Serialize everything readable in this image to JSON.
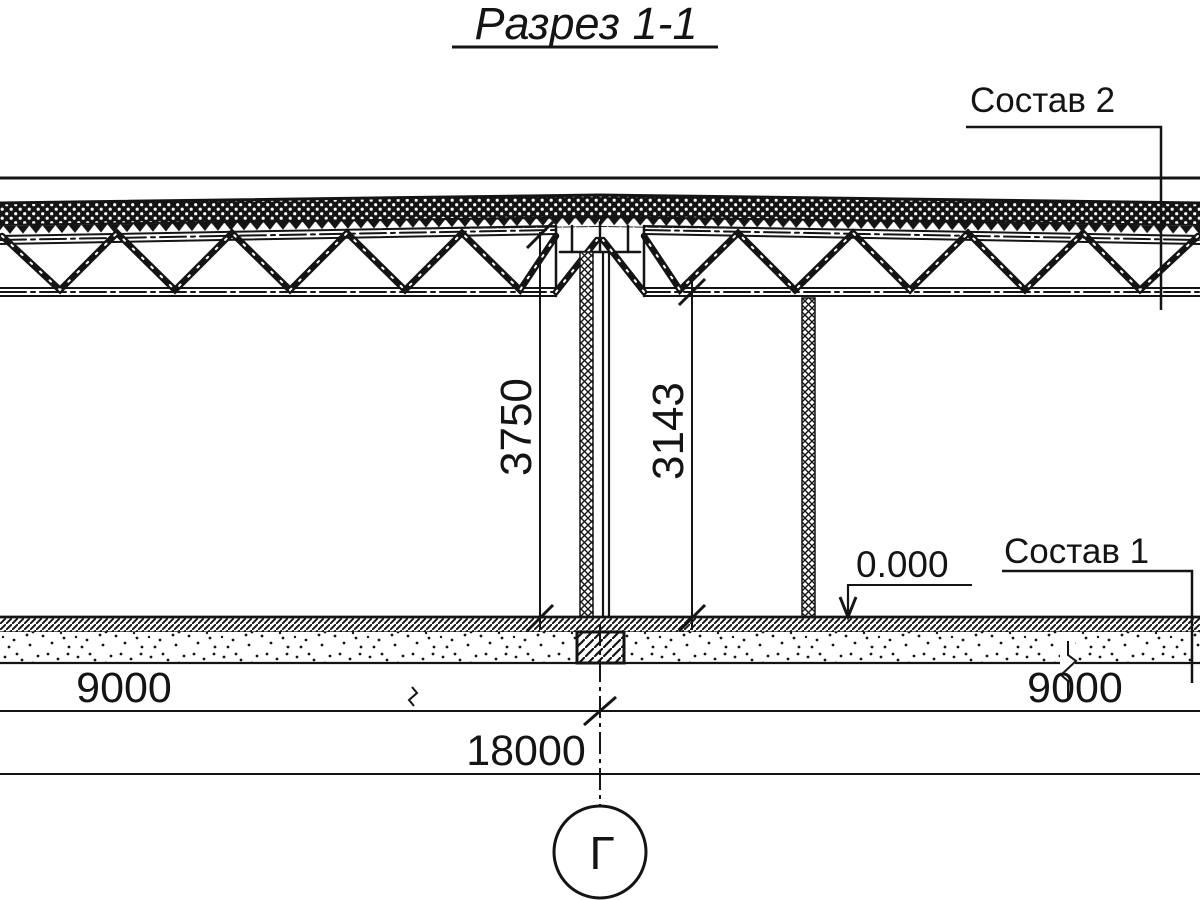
{
  "drawing": {
    "title": "Разрез 1-1",
    "callouts": {
      "roof": "Состав 2",
      "floor": "Состав 1"
    },
    "elevation": "0.000",
    "axis": "Г",
    "dims": {
      "left_height": "3750",
      "right_height": "3143",
      "bay_left": "9000",
      "bay_right": "9000",
      "total": "18000"
    },
    "colors": {
      "ink": "#141414",
      "paper": "#ffffff"
    }
  }
}
